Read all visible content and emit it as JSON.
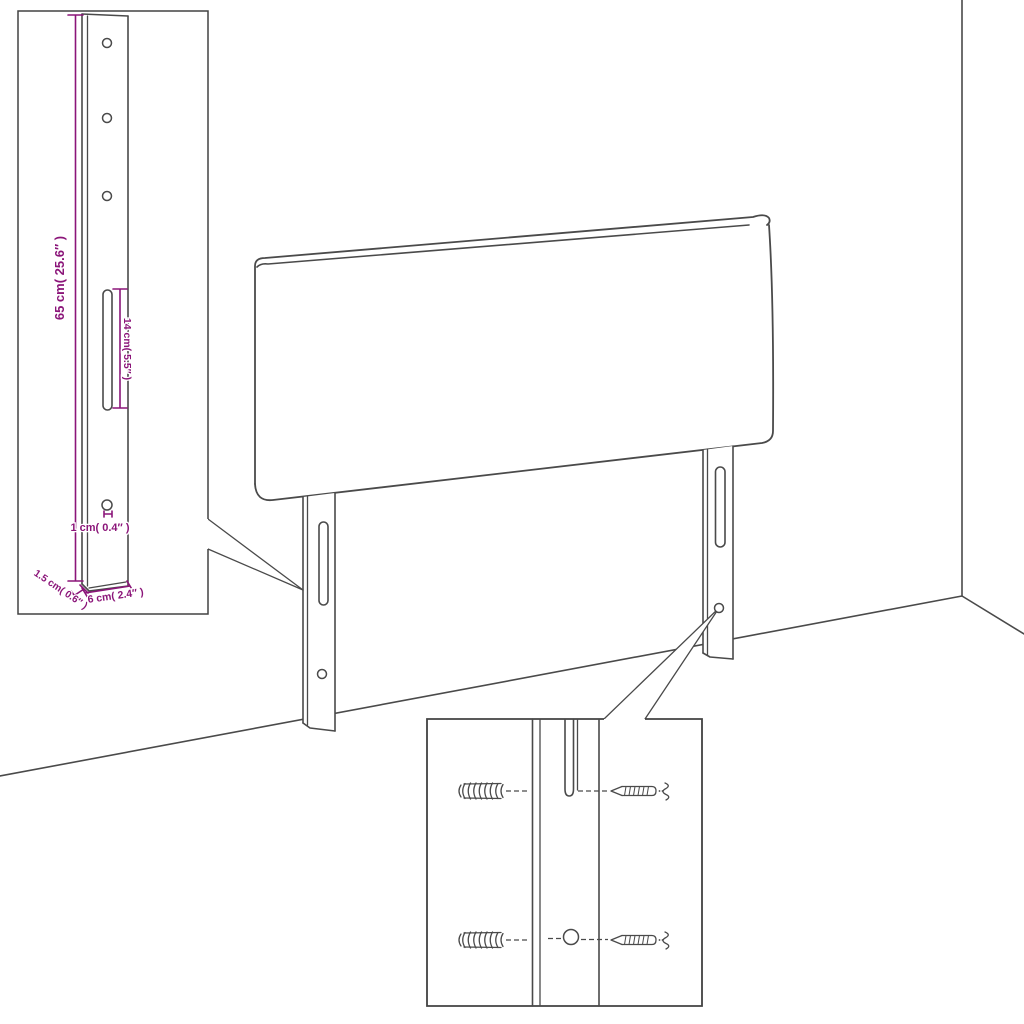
{
  "diagram": {
    "kind": "headboard-assembly-line-drawing",
    "colors": {
      "background": "#ffffff",
      "line_art": "#4a4a4a",
      "dimension_accent": "#8b1579"
    },
    "dimensions": {
      "leg_height": "65 cm( 25.6″ )",
      "slot_length": "14 cm( 5.5″ )",
      "hole_diameter": "1 cm( 0.4″ )",
      "leg_thickness": "1.5 cm( 0.6″ )",
      "leg_width": "6 cm( 2.4″ )"
    }
  }
}
